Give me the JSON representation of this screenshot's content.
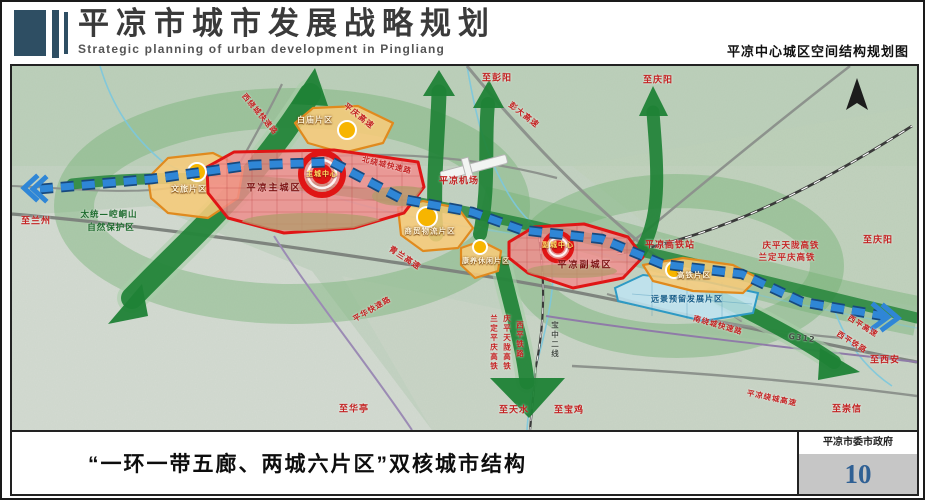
{
  "header": {
    "title": "平凉市城市发展战略规划",
    "subtitle_en": "Strategic planning of urban development in Pingliang",
    "map_caption": "平凉中心城区空间结构规划图"
  },
  "map": {
    "colors": {
      "terrain_green": "#c4d3c3",
      "corridor_green": "#1f8236",
      "axis_blue": "#2f86d6",
      "core_red": "#e01515",
      "district_orange": "#e08a1e",
      "reserve_blue": "#2e9ac4"
    },
    "labels": [
      {
        "t": "至兰州",
        "x": 24,
        "y": 154,
        "c": "red"
      },
      {
        "t": "太统—崆峒山",
        "x": 97,
        "y": 148,
        "c": "green",
        "s": 8.5
      },
      {
        "t": "自然保护区",
        "x": 99,
        "y": 161,
        "c": "green",
        "s": 8.5
      },
      {
        "t": "文旅片区",
        "x": 177,
        "y": 123,
        "c": "zone",
        "s": 8
      },
      {
        "t": "平凉主城区",
        "x": 262,
        "y": 121,
        "c": "city"
      },
      {
        "t": "主城中心",
        "x": 310,
        "y": 108,
        "c": "center",
        "s": 7
      },
      {
        "t": "白庙片区",
        "x": 303,
        "y": 54,
        "c": "zone",
        "s": 8
      },
      {
        "t": "平庆高速",
        "x": 347,
        "y": 50,
        "c": "red",
        "r": 38,
        "s": 8
      },
      {
        "t": "西绕城快速路",
        "x": 248,
        "y": 48,
        "c": "red",
        "r": 50,
        "s": 7.5
      },
      {
        "t": "北绕城快速路",
        "x": 375,
        "y": 99,
        "c": "red",
        "r": 14,
        "s": 7.5
      },
      {
        "t": "彭大高速",
        "x": 512,
        "y": 49,
        "c": "red",
        "r": 38,
        "s": 8
      },
      {
        "t": "至彭阳",
        "x": 485,
        "y": 11,
        "c": "red"
      },
      {
        "t": "至庆阳",
        "x": 646,
        "y": 13,
        "c": "red"
      },
      {
        "t": "平凉机场",
        "x": 447,
        "y": 114,
        "c": "red"
      },
      {
        "t": "青兰高速",
        "x": 393,
        "y": 192,
        "c": "red",
        "r": 33,
        "s": 8
      },
      {
        "t": "商贸物流片区",
        "x": 418,
        "y": 165,
        "c": "zone",
        "s": 7.5
      },
      {
        "t": "康养休闲片区",
        "x": 474,
        "y": 195,
        "c": "zone",
        "s": 7
      },
      {
        "t": "副城中心",
        "x": 546,
        "y": 179,
        "c": "center",
        "s": 7
      },
      {
        "t": "平凉副城区",
        "x": 573,
        "y": 198,
        "c": "city",
        "s": 9
      },
      {
        "t": "平凉高铁站",
        "x": 658,
        "y": 178,
        "c": "red"
      },
      {
        "t": "庆平天陇高铁",
        "x": 779,
        "y": 179,
        "c": "red",
        "s": 8.5
      },
      {
        "t": "兰定平庆高铁",
        "x": 775,
        "y": 191,
        "c": "red",
        "s": 8.5
      },
      {
        "t": "至庆阳",
        "x": 866,
        "y": 173,
        "c": "red"
      },
      {
        "t": "高铁片区",
        "x": 682,
        "y": 209,
        "c": "zone",
        "s": 7.5
      },
      {
        "t": "远景预留发展片区",
        "x": 675,
        "y": 233,
        "c": "blue",
        "s": 8
      },
      {
        "t": "南绕城快速路",
        "x": 706,
        "y": 259,
        "c": "red",
        "r": 16,
        "s": 7.5
      },
      {
        "t": "G312",
        "x": 790,
        "y": 272,
        "c": "gray",
        "r": 8,
        "s": 8
      },
      {
        "t": "西平高速",
        "x": 851,
        "y": 260,
        "c": "red",
        "r": 32,
        "s": 7.5
      },
      {
        "t": "西平铁路",
        "x": 840,
        "y": 276,
        "c": "red",
        "r": 32,
        "s": 7.5
      },
      {
        "t": "至西安",
        "x": 873,
        "y": 293,
        "c": "red"
      },
      {
        "t": "至崇信",
        "x": 835,
        "y": 342,
        "c": "red"
      },
      {
        "t": "平凉绕城高速",
        "x": 760,
        "y": 332,
        "c": "red",
        "r": 12,
        "s": 7.5
      },
      {
        "t": "至华亭",
        "x": 342,
        "y": 342,
        "c": "red"
      },
      {
        "t": "平华快速路",
        "x": 360,
        "y": 243,
        "c": "red",
        "r": -30,
        "s": 7.5
      },
      {
        "t": "兰定平庆高铁",
        "x": 482,
        "y": 277,
        "c": "red",
        "v": 1,
        "s": 7.5
      },
      {
        "t": "庆平天陇高铁",
        "x": 495,
        "y": 277,
        "c": "red",
        "v": 1,
        "s": 7.5
      },
      {
        "t": "西平铁路",
        "x": 508,
        "y": 274,
        "c": "red",
        "v": 1,
        "s": 7.5
      },
      {
        "t": "宝中二线",
        "x": 543,
        "y": 274,
        "c": "gray",
        "v": 1,
        "s": 7.5
      },
      {
        "t": "至天水",
        "x": 502,
        "y": 343,
        "c": "red"
      },
      {
        "t": "至宝鸡",
        "x": 557,
        "y": 343,
        "c": "red"
      }
    ]
  },
  "footer": {
    "caption": "“一环一带五廊、两城六片区”双核城市结构",
    "org": "平凉市委市政府",
    "page": "10"
  }
}
